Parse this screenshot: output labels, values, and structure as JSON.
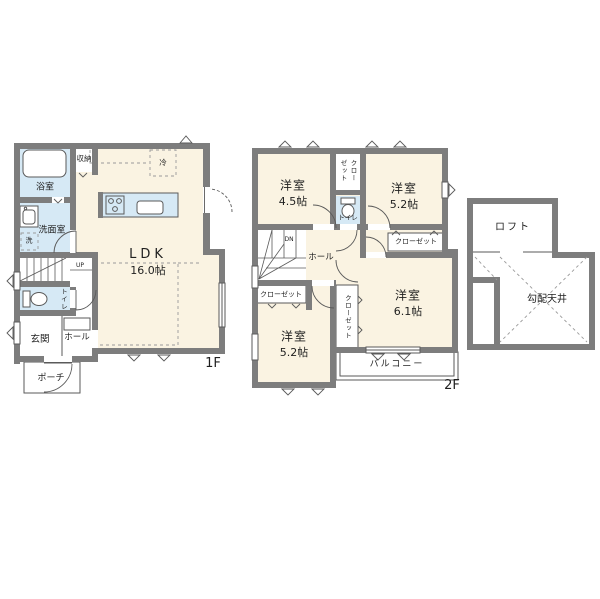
{
  "colors": {
    "wall": "#7d7d7d",
    "room": "#faf3e2",
    "wet": "#d6e9f5",
    "line": "#5a5a5a",
    "dash": "#9a9a9a",
    "text": "#1f1f1f"
  },
  "floor1": {
    "floor_label": "1F",
    "ldk": {
      "name": "LDK",
      "size": "16.0帖"
    },
    "bathroom": "浴室",
    "washroom": "洗面室",
    "storage": "収納",
    "toilet": "トイレ",
    "entrance": "玄関",
    "hall": "ホール",
    "porch": "ポーチ",
    "stairs_up": "UP",
    "fridge": "冷",
    "laundry": "洗"
  },
  "floor2": {
    "floor_label": "2F",
    "room_a": {
      "name": "洋室",
      "size": "4.5帖"
    },
    "room_b": {
      "name": "洋室",
      "size": "5.2帖"
    },
    "room_c": {
      "name": "洋室",
      "size": "6.1帖"
    },
    "room_d": {
      "name": "洋室",
      "size": "5.2帖"
    },
    "toilet": "トイレ",
    "hall": "ホール",
    "closet_top": "クローゼット",
    "closet_right": "クローゼット",
    "closet_left": "クローゼット",
    "closet_center": "クローゼット",
    "balcony": "バルコニー",
    "stairs_down": "DN"
  },
  "loft": {
    "loft": "ロフト",
    "sloped_ceiling": "勾配天井"
  }
}
